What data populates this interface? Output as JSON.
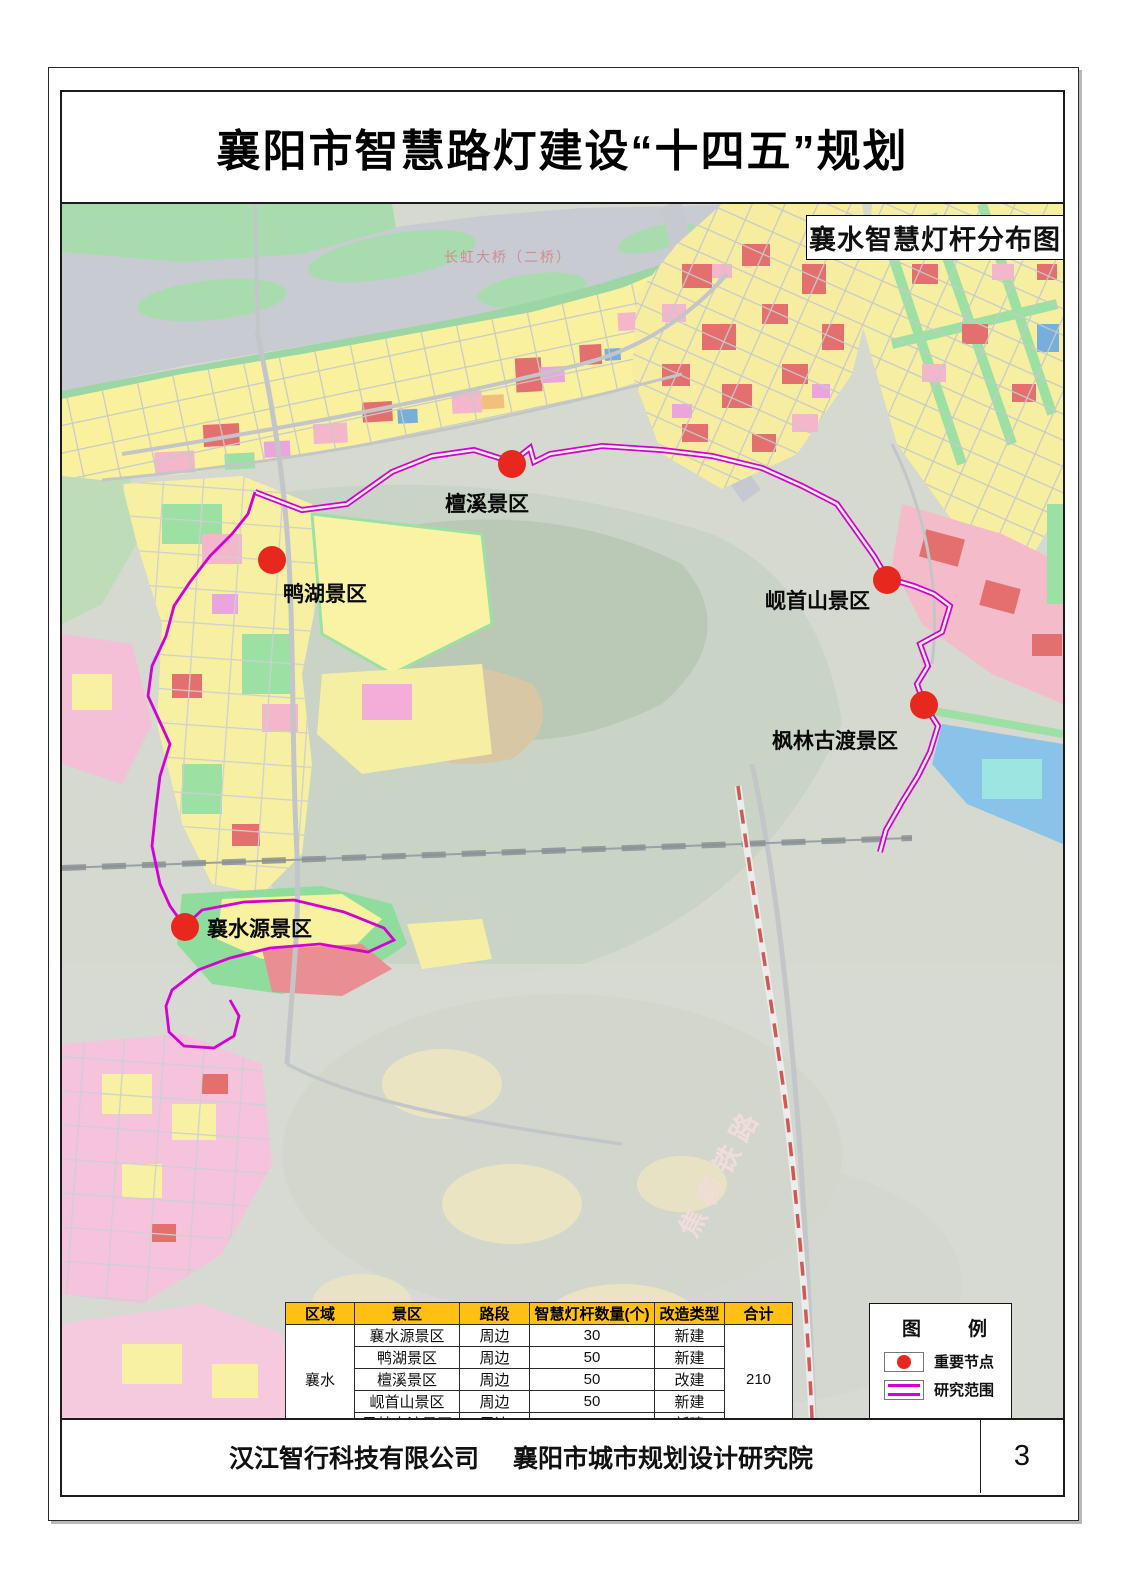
{
  "page": {
    "title": "襄阳市智慧路灯建设“十四五”规划",
    "page_number": "3",
    "footer": {
      "company1": "汉江智行科技有限公司",
      "company2": "襄阳市城市规划设计研究院"
    }
  },
  "map": {
    "title": "襄水智慧灯杆分布图",
    "markers": [
      {
        "label": "檀溪景区"
      },
      {
        "label": "鸭湖景区"
      },
      {
        "label": "岘首山景区"
      },
      {
        "label": "枫林古渡景区"
      },
      {
        "label": "襄水源景区"
      }
    ],
    "annotations": {
      "bridge": "长虹大桥（二桥）",
      "railway": "焦柳铁路"
    },
    "colors": {
      "important_node": "#e8281e",
      "study_boundary": "#d400d4"
    }
  },
  "table": {
    "headers": [
      "区域",
      "景区",
      "路段",
      "智慧灯杆数量(个)",
      "改造类型",
      "合计"
    ],
    "region": "襄水",
    "total": "210",
    "header_color": "#ffc013",
    "rows": [
      {
        "scenic": "襄水源景区",
        "road": "周边",
        "count": "30",
        "type": "新建"
      },
      {
        "scenic": "鸭湖景区",
        "road": "周边",
        "count": "50",
        "type": "新建"
      },
      {
        "scenic": "檀溪景区",
        "road": "周边",
        "count": "50",
        "type": "改建"
      },
      {
        "scenic": "岘首山景区",
        "road": "周边",
        "count": "50",
        "type": "新建"
      },
      {
        "scenic": "凤林古渡景区",
        "road": "周边",
        "count": "30",
        "type": "新建"
      }
    ]
  },
  "legend": {
    "title": "图　例",
    "items": [
      {
        "label": "重要节点"
      },
      {
        "label": "研究范围"
      }
    ]
  }
}
